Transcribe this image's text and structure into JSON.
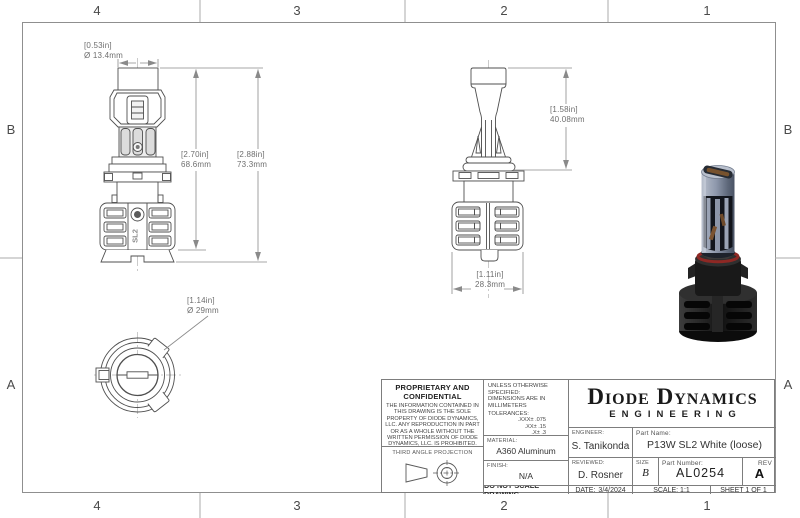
{
  "colors": {
    "line": "#4f4f4f",
    "dim": "#8a8a8a",
    "dim_text": "#6e6e6e",
    "tb_line": "#7d7d7d",
    "centerline": "#b5b5b5",
    "ring_red": "#8e2824",
    "body_slate": "#8d97ab",
    "black_part": "#191919"
  },
  "zones": {
    "top": [
      "4",
      "3",
      "2",
      "1"
    ],
    "bottom": [
      "4",
      "3",
      "2",
      "1"
    ],
    "left": [
      "B",
      "A"
    ],
    "right": [
      "B",
      "A"
    ]
  },
  "views": {
    "part_logo": "SL2"
  },
  "dimensions": {
    "cap_diameter": {
      "in": "[0.53in]",
      "mm": "Ø 13.4mm"
    },
    "body_height": {
      "in": "[2.70in]",
      "mm": "68.6mm"
    },
    "overall_height": {
      "in": "[2.88in]",
      "mm": "73.3mm"
    },
    "base_diameter": {
      "in": "[1.14in]",
      "mm": "Ø 29mm"
    },
    "upper_height": {
      "in": "[1.58in]",
      "mm": "40.08mm"
    },
    "heatsink_width": {
      "in": "[1.11in]",
      "mm": "28.3mm"
    }
  },
  "title_block": {
    "proprietary_title": "PROPRIETARY AND CONFIDENTIAL",
    "proprietary_body": "THE INFORMATION CONTAINED IN THIS DRAWING IS THE SOLE PROPERTY OF DIODE DYNAMICS, LLC.  ANY REPRODUCTION IN PART OR AS A WHOLE WITHOUT THE WRITTEN PERMISSION OF DIODE DYNAMICS, LLC. IS PROHIBITED.",
    "third_angle_label": "THIRD ANGLE PROJECTION",
    "spec_line1": "UNLESS OTHERWISE SPECIFIED:",
    "spec_line2": "DIMENSIONS ARE IN MILLIMETERS",
    "tolerances_label": "TOLERANCES:",
    "tolerances": [
      ".XXX± .075",
      ".XX± .15",
      ".X± .3",
      "X± .5",
      "ANG± 1"
    ],
    "material_label": "MATERIAL:",
    "material_value": "A360 Aluminum",
    "finish_label": "FINISH:",
    "finish_value": "N/A",
    "do_not_scale": "DO NOT SCALE DRAWING",
    "logo_line1": "Diode Dynamics",
    "logo_line2": "ENGINEERING",
    "engineer_label": "ENGINEER:",
    "engineer_value": "S. Tanikonda",
    "reviewed_label": "REVIEWED:",
    "reviewed_value": "D. Rosner",
    "date_label": "DATE:",
    "date_value": "3/4/2024",
    "part_name_label": "Part Name:",
    "part_name_value": "P13W SL2 White (loose)",
    "size_label": "SIZE",
    "size_value": "B",
    "part_number_label": "Part Number:",
    "part_number_value": "AL0254",
    "rev_label": "REV",
    "rev_value": "A",
    "scale_text": "SCALE: 1:1",
    "sheet_text": "SHEET 1 OF 1"
  }
}
